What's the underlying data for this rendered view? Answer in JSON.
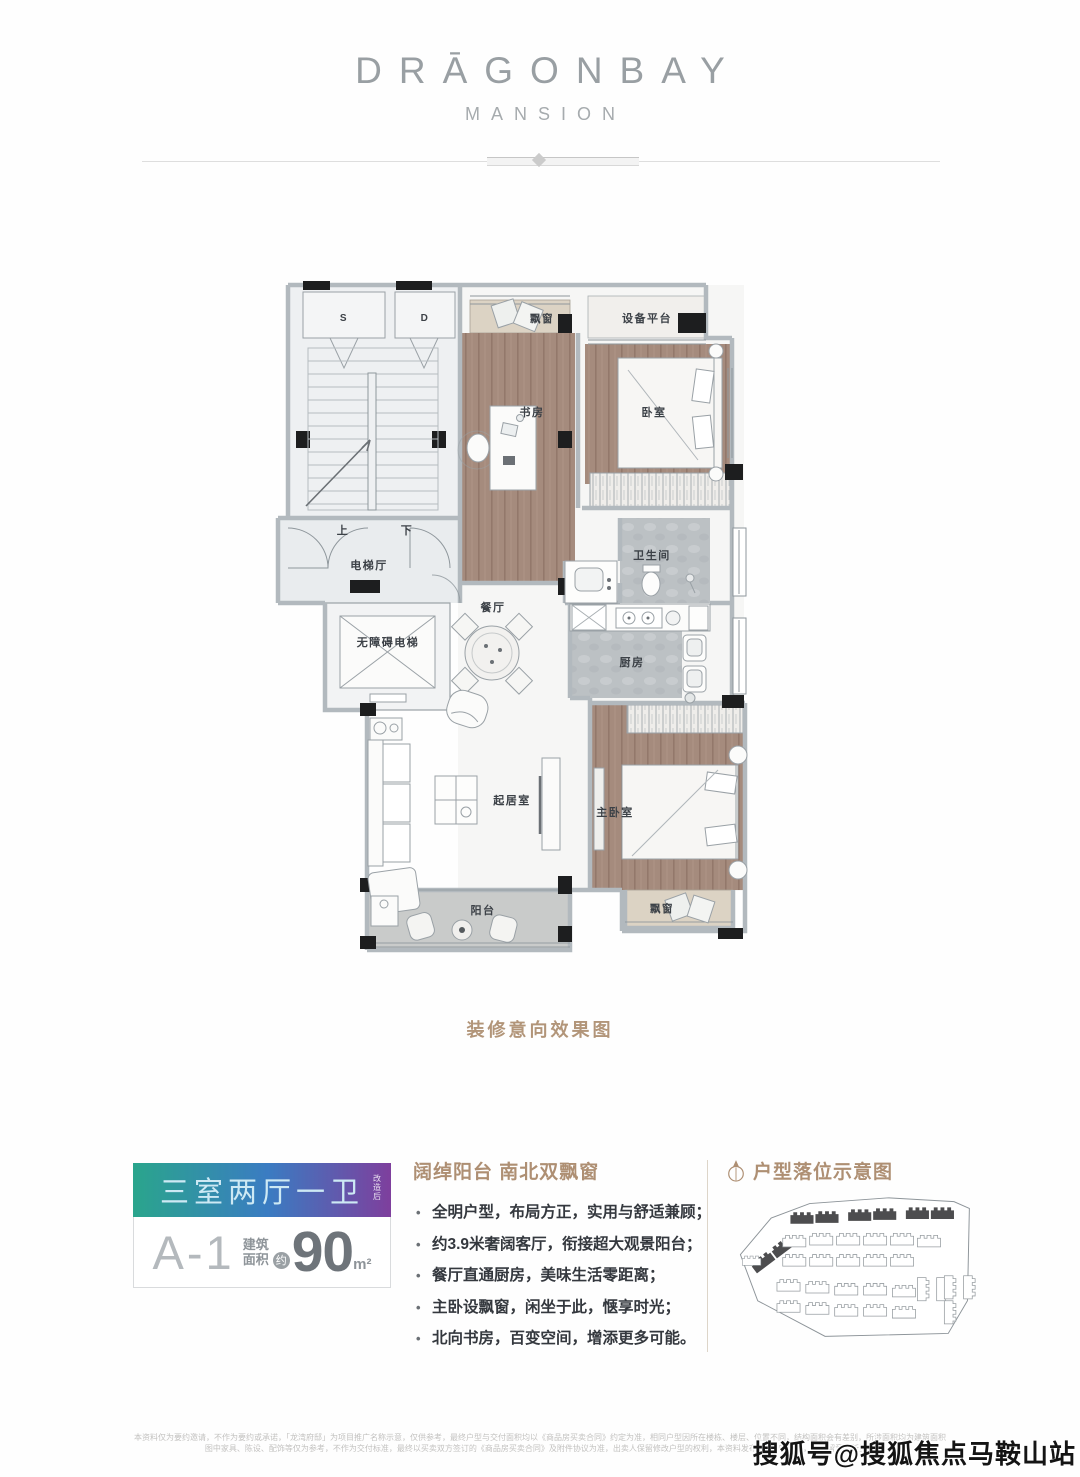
{
  "header": {
    "brand": "DRĀGONBAY",
    "brand_sub": "MANSION"
  },
  "floorplan": {
    "caption": "装修意向效果图",
    "rooms": {
      "s": "S",
      "d": "D",
      "up": "上",
      "down": "下",
      "elevator_hall": "电梯厅",
      "accessible_elevator": "无障碍电梯",
      "bay_top": "飘窗",
      "equipment": "设备平台",
      "study": "书房",
      "bedroom": "卧室",
      "bath": "卫生间",
      "dining": "餐厅",
      "kitchen": "厨房",
      "living": "起居室",
      "master": "主卧室",
      "balcony": "阳台",
      "bay_bottom": "飘窗"
    }
  },
  "info": {
    "badge": {
      "type_label": "三室两厅一卫",
      "type_note": "改造后",
      "unit": "A-1",
      "area_prefix_1": "建筑",
      "area_prefix_2": "面积",
      "approx": "约",
      "area_value": "90",
      "area_unit": "m²"
    },
    "features": {
      "title": "阔绰阳台 南北双飘窗",
      "bullets": [
        "全明户型，布局方正，实用与舒适兼顾；",
        "约3.9米奢阔客厅，衔接超大观景阳台；",
        "餐厅直通厨房，美味生活零距离；",
        "主卧设飘窗，闲坐于此，惬享时光；",
        "北向书房，百变空间，增添更多可能。"
      ]
    },
    "siteplan": {
      "title": "户型落位示意图"
    }
  },
  "footer": {
    "disclaimer_line1": "本资料仅为要约邀请，不作为要约或承诺，「龙湾府邸」为项目推广名称示意，仅供参考，最终户型与交付面积均以《商品房买卖合同》约定为准，相同户型因所在楼栋、楼层、位置不同，结构面积会有差别，所涉面积均为建筑面积",
    "disclaimer_line2": "图中家具、陈设、配饰等仅为参考，不作为交付标准，最终以买卖双方签订的《商品房买卖合同》及附件协议为准，出卖人保留修改户型的权利，本资料发布于2020年7月，敬请留意最新资料",
    "watermark": "搜狐号@搜狐焦点马鞍山站"
  },
  "colors": {
    "accent_brown": "#ae8f73",
    "gradient_left": "#2aa58c",
    "gradient_mid": "#3a7cc2",
    "gradient_right": "#7e3f9d",
    "wood_floor": "#a58b7d",
    "tile_floor": "#bcc1c4"
  }
}
